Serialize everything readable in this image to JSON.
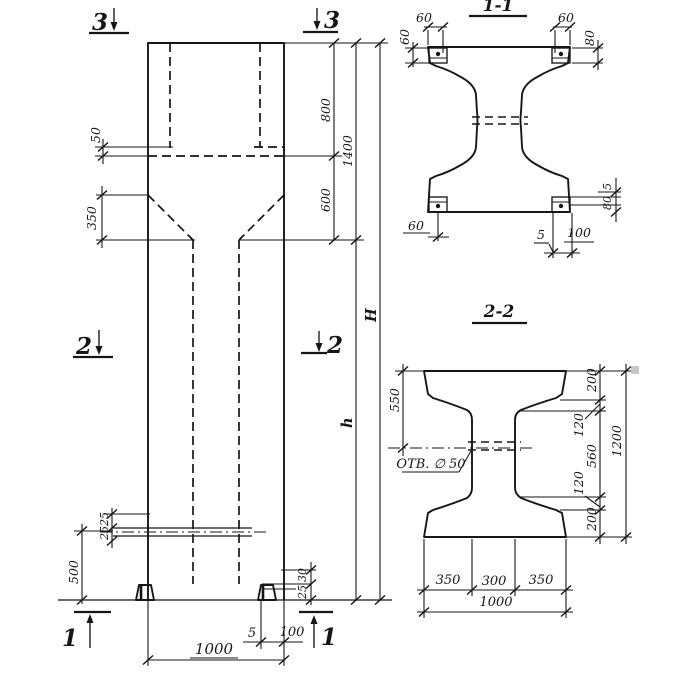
{
  "title": "Precast reinforced concrete column working drawing",
  "colors": {
    "ink": "#161616",
    "paper": "#ffffff"
  },
  "elevation": {
    "markers": {
      "top_left": "3",
      "top_right": "3",
      "mid_left": "2",
      "mid_right": "2",
      "bottom_left": "1",
      "bottom_right": "1"
    },
    "dims": {
      "d800": "800",
      "d1400": "1400",
      "d600": "600",
      "dH": "H",
      "dh": "h",
      "d50": "50",
      "d350": "350",
      "d500": "500",
      "d25a": "25",
      "d25b": "25",
      "d30": "30",
      "d25c": "25",
      "d5": "5",
      "d100": "100",
      "d1000": "1000"
    }
  },
  "section11": {
    "title": "1-1",
    "dims": {
      "tl60": "60",
      "tl60r": "60",
      "tr60": "60",
      "tr80": "80",
      "bl60": "60",
      "r5": "5",
      "r80": "80",
      "b5": "5",
      "b100": "100"
    }
  },
  "section22": {
    "title": "2-2",
    "hole": "ОТВ. ∅ 50",
    "dims": {
      "d550": "550",
      "d200a": "200",
      "d120a": "120",
      "d560": "560",
      "d120b": "120",
      "d200b": "200",
      "d1200": "1200",
      "d350a": "350",
      "d300": "300",
      "d350b": "350",
      "d1000": "1000"
    }
  }
}
